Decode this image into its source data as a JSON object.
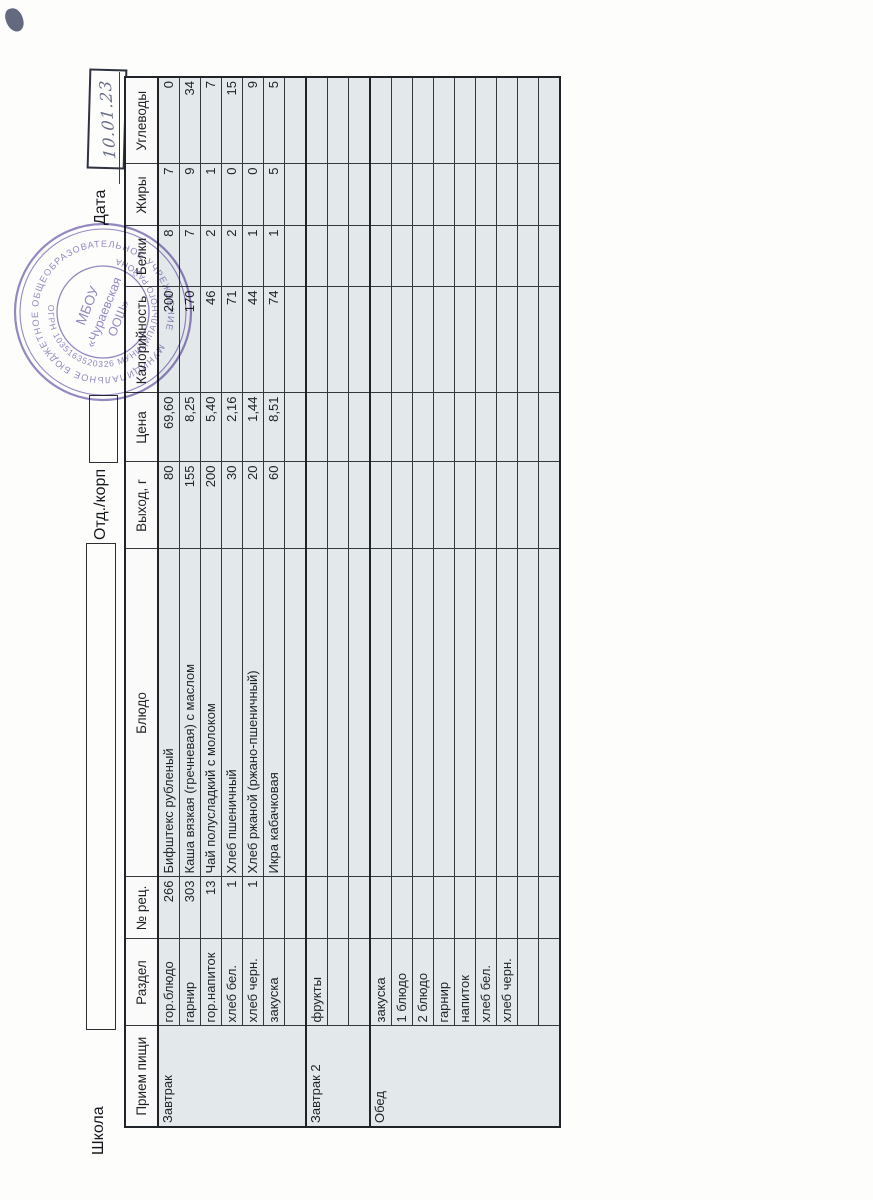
{
  "form": {
    "school_label": "Школа",
    "dept_label": "Отд./корп",
    "date_label": "Дата",
    "handwritten_date": "10.01.23"
  },
  "stamp": {
    "ring_text_top": "МУНИЦИПАЛЬНОЕ БЮДЖЕТНОЕ ОБЩЕОБРАЗОВАТЕЛЬНОЕ УЧРЕЖДЕНИЕ",
    "ring_text_bottom": "ОГРН 1035163520326 МУНИЦИПАЛЬНОГО РАЙОНА",
    "center_line1": "МБОУ",
    "center_line2": "«Чураевская",
    "center_line3": "ООШ»",
    "color": "#7d6db3"
  },
  "table": {
    "headers": [
      "Прием пищи",
      "Раздел",
      "№ рец.",
      "Блюдо",
      "Выход, г",
      "Цена",
      "Калорийность",
      "Белки",
      "Жиры",
      "Углеводы"
    ],
    "col_widths": [
      101,
      87,
      62,
      328,
      87,
      69,
      106,
      61,
      62,
      87
    ],
    "sections": [
      {
        "meal": "Завтрак",
        "rows": [
          {
            "razdel": "гор.блюдо",
            "num": "266",
            "dish": "Бифштекс рубленый",
            "out": "80",
            "price": "69,60",
            "kcal": "200",
            "prot": "8",
            "fat": "7",
            "carb": "0"
          },
          {
            "razdel": "гарнир",
            "num": "303",
            "dish": "Каша вязкая (гречневая) с маслом",
            "out": "155",
            "price": "8,25",
            "kcal": "170",
            "prot": "7",
            "fat": "9",
            "carb": "34"
          },
          {
            "razdel": "гор.напиток",
            "num": "13",
            "dish": "Чай полусладкий с молоком",
            "out": "200",
            "price": "5,40",
            "kcal": "46",
            "prot": "2",
            "fat": "1",
            "carb": "7"
          },
          {
            "razdel": "хлеб бел.",
            "num": "1",
            "dish": "Хлеб пшеничный",
            "out": "30",
            "price": "2,16",
            "kcal": "71",
            "prot": "2",
            "fat": "0",
            "carb": "15"
          },
          {
            "razdel": "хлеб черн.",
            "num": "1",
            "dish": "Хлеб ржаной (ржано-пшеничный)",
            "out": "20",
            "price": "1,44",
            "kcal": "44",
            "prot": "1",
            "fat": "0",
            "carb": "9"
          },
          {
            "razdel": "закуска",
            "num": "",
            "dish": "Икра кабачковая",
            "out": "60",
            "price": "8,51",
            "kcal": "74",
            "prot": "1",
            "fat": "5",
            "carb": "5"
          },
          {
            "razdel": "",
            "num": "",
            "dish": "",
            "out": "",
            "price": "",
            "kcal": "",
            "prot": "",
            "fat": "",
            "carb": ""
          }
        ]
      },
      {
        "meal": "Завтрак 2",
        "rows": [
          {
            "razdel": "фрукты",
            "num": "",
            "dish": "",
            "out": "",
            "price": "",
            "kcal": "",
            "prot": "",
            "fat": "",
            "carb": ""
          },
          {
            "razdel": "",
            "num": "",
            "dish": "",
            "out": "",
            "price": "",
            "kcal": "",
            "prot": "",
            "fat": "",
            "carb": ""
          },
          {
            "razdel": "",
            "num": "",
            "dish": "",
            "out": "",
            "price": "",
            "kcal": "",
            "prot": "",
            "fat": "",
            "carb": ""
          }
        ]
      },
      {
        "meal": "Обед",
        "rows": [
          {
            "razdel": "закуска",
            "num": "",
            "dish": "",
            "out": "",
            "price": "",
            "kcal": "",
            "prot": "",
            "fat": "",
            "carb": ""
          },
          {
            "razdel": "1 блюдо",
            "num": "",
            "dish": "",
            "out": "",
            "price": "",
            "kcal": "",
            "prot": "",
            "fat": "",
            "carb": ""
          },
          {
            "razdel": "2 блюдо",
            "num": "",
            "dish": "",
            "out": "",
            "price": "",
            "kcal": "",
            "prot": "",
            "fat": "",
            "carb": ""
          },
          {
            "razdel": "гарнир",
            "num": "",
            "dish": "",
            "out": "",
            "price": "",
            "kcal": "",
            "prot": "",
            "fat": "",
            "carb": ""
          },
          {
            "razdel": "напиток",
            "num": "",
            "dish": "",
            "out": "",
            "price": "",
            "kcal": "",
            "prot": "",
            "fat": "",
            "carb": ""
          },
          {
            "razdel": "хлеб бел.",
            "num": "",
            "dish": "",
            "out": "",
            "price": "",
            "kcal": "",
            "prot": "",
            "fat": "",
            "carb": ""
          },
          {
            "razdel": "хлеб черн.",
            "num": "",
            "dish": "",
            "out": "",
            "price": "",
            "kcal": "",
            "prot": "",
            "fat": "",
            "carb": ""
          },
          {
            "razdel": "",
            "num": "",
            "dish": "",
            "out": "",
            "price": "",
            "kcal": "",
            "prot": "",
            "fat": "",
            "carb": ""
          },
          {
            "razdel": "",
            "num": "",
            "dish": "",
            "out": "",
            "price": "",
            "kcal": "",
            "prot": "",
            "fat": "",
            "carb": ""
          }
        ]
      }
    ]
  },
  "colors": {
    "cell_fill": "#e3e8eb",
    "header_fill": "#f9faf9",
    "grid": "#34373b",
    "stamp": "#7d6db3",
    "handwriting_ink": "#4d5470"
  }
}
